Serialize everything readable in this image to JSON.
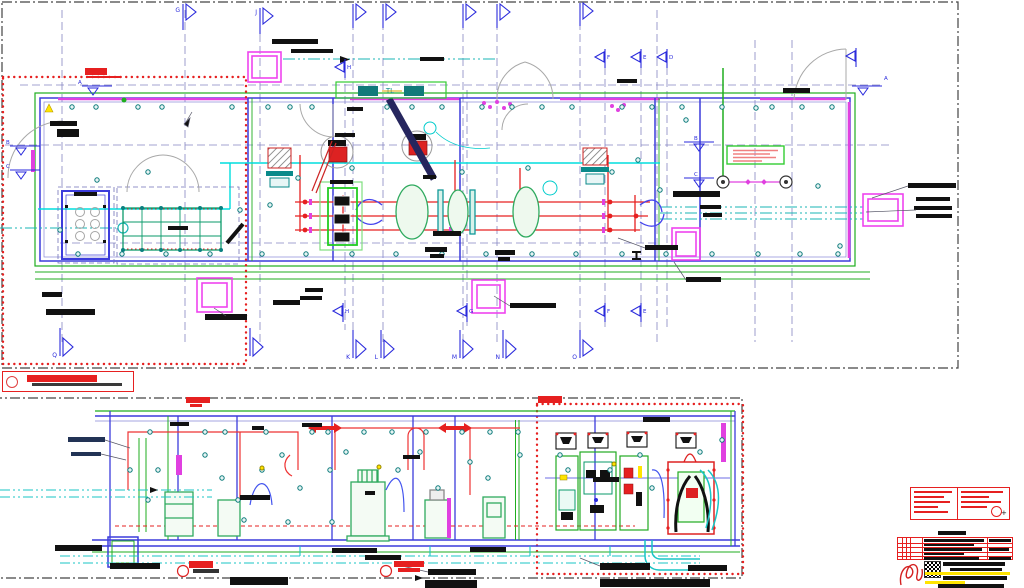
{
  "palette": {
    "grid_blue": "#2a2adc",
    "wall_green": "#1fae1f",
    "wall_blue": "#3c3cdc",
    "magenta": "#e040e0",
    "cyan": "#00dddd",
    "teal": "#119999",
    "revision_red": "#e62020",
    "highlight_yellow": "#ffe400",
    "text_black": "#111111"
  },
  "upper_plan": {
    "grid_letters_top": [
      {
        "letter": "G"
      },
      {
        "letter": "J"
      }
    ],
    "grid_letters_bottom": [
      {
        "letter": "Q"
      },
      {
        "letter": "K"
      },
      {
        "letter": "L"
      },
      {
        "letter": "M"
      },
      {
        "letter": "N"
      },
      {
        "letter": "O"
      }
    ],
    "section_letters_top": [
      {
        "letter": "H"
      },
      {
        "letter": "F"
      },
      {
        "letter": "E"
      },
      {
        "letter": "D"
      }
    ],
    "section_letters_bottom": [
      {
        "letter": "H"
      },
      {
        "letter": "G"
      },
      {
        "letter": "F"
      },
      {
        "letter": "E"
      }
    ],
    "level_letters": [
      {
        "letter": "A"
      },
      {
        "letter": "B"
      },
      {
        "letter": "C"
      },
      {
        "letter": "B"
      },
      {
        "letter": "C"
      },
      {
        "letter": "A"
      }
    ],
    "cable_tray_label": "TL"
  }
}
